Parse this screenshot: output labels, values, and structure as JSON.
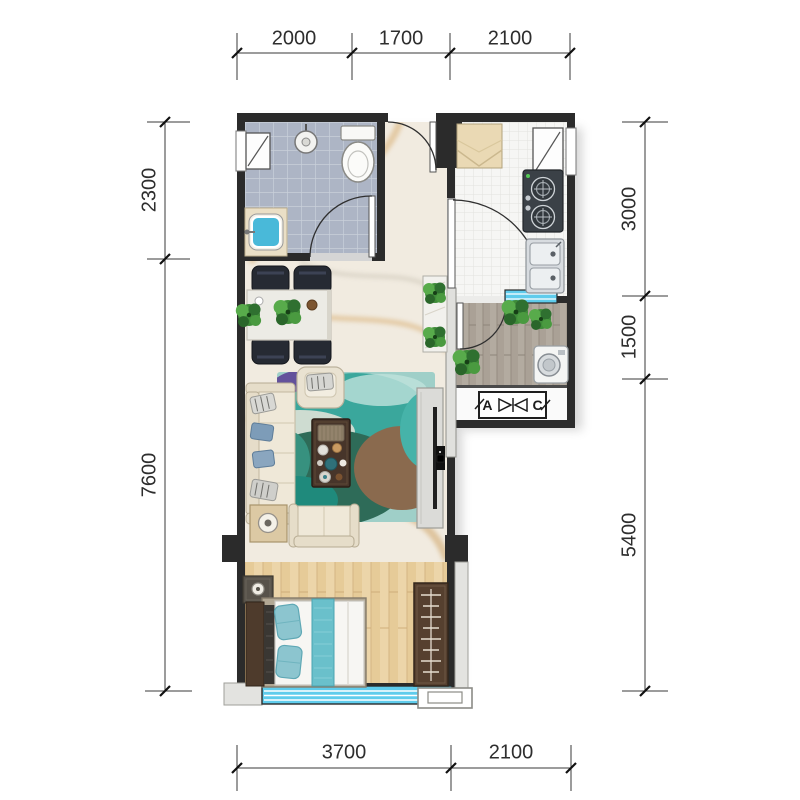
{
  "floor_plan": {
    "type": "apartment-floor-plan",
    "dimensions_mm": {
      "top": [
        "2000",
        "1700",
        "2100"
      ],
      "bottom": [
        "3700",
        "2100"
      ],
      "left": [
        "2300",
        "7600"
      ],
      "right": [
        "3000",
        "1500",
        "5400"
      ]
    },
    "ac_platform": {
      "label_left": "A",
      "label_right": "C",
      "symbol": "bowtie"
    },
    "colors": {
      "wall": "#2b2b2b",
      "window_glass": "#5fccec",
      "bath_tile": "#adb5c5",
      "kitchen_tile": "#f6f6f4",
      "marble_floor": "#f1ebe0",
      "bedroom_wood": "#ecd5a9",
      "balcony_wood": "#b3aba0",
      "rug_teal": "#3aa79c"
    },
    "fixtures": [
      "toilet",
      "shower-head",
      "wash-basin",
      "bathroom-window",
      "entry-door",
      "fridge",
      "gas-stove",
      "kitchen-sink",
      "kitchen-window",
      "dining-table",
      "dining-chairs",
      "hall-cabinet",
      "sofa",
      "armchair",
      "loveseat",
      "coffee-table",
      "area-rug",
      "side-table-lamp",
      "tv-console",
      "tv",
      "balcony-plants",
      "washing-machine",
      "ac-platform",
      "bed",
      "pillows",
      "bed-runner",
      "nightstand",
      "wardrobe",
      "bay-window"
    ]
  }
}
